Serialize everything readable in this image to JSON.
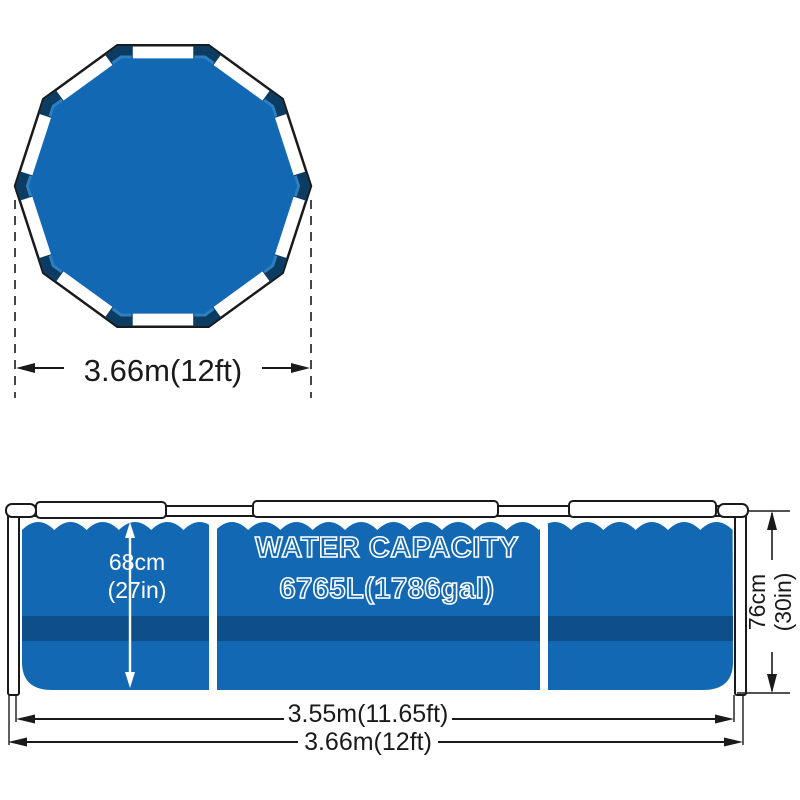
{
  "top_view": {
    "name": "pool top view (decagon frame)",
    "diameter_label": "3.66m(12ft)"
  },
  "side_view": {
    "name": "pool side cross-section view",
    "capacity_title": "WATER CAPACITY",
    "capacity_value": "6765L(1786gal)",
    "water_depth_cm": "68cm",
    "water_depth_in": "(27in)",
    "frame_height_cm": "76cm",
    "frame_height_in": "(30in)",
    "liner_width_label": "3.55m(11.65ft)",
    "frame_width_label": "3.66m(12ft)"
  },
  "colors": {
    "pool_blue": "#1268b3",
    "band_dark_blue": "#0e4f8a",
    "connector_navy": "#0c3c62",
    "connector_accent_blue": "#2e7fc0",
    "outline_black": "#1a1a1a",
    "frame_white": "#ffffff"
  }
}
